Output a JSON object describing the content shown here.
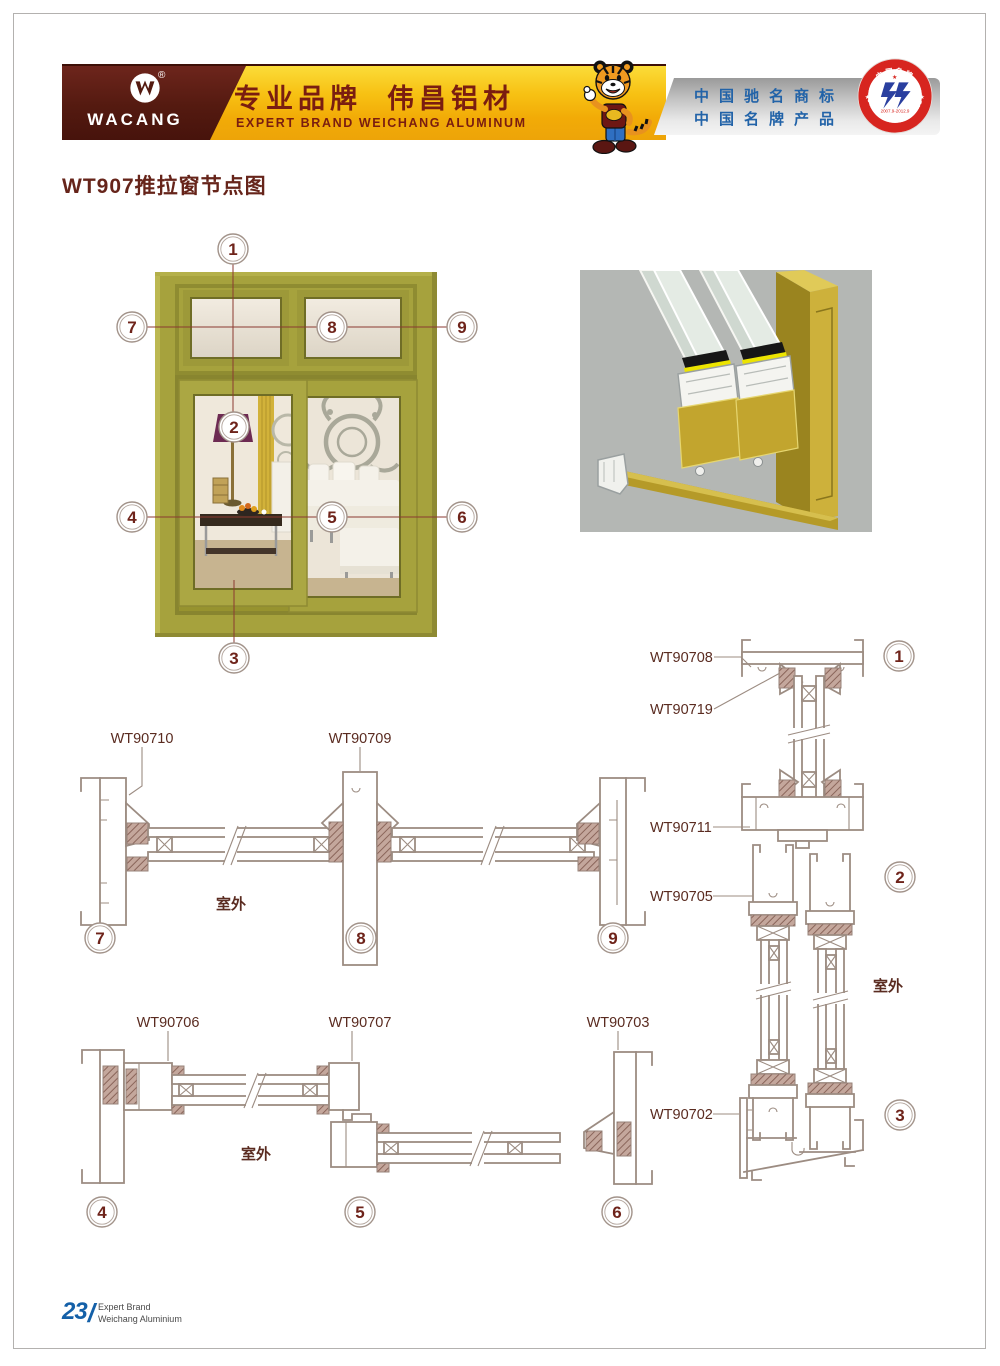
{
  "brand_colors": {
    "maroon": "#541a10",
    "gold": "#f7c113",
    "honor_blue": "#2263a8",
    "olive_frame": "#a6a23d",
    "badge_red": "#d7251f",
    "footer_blue": "#1460a8"
  },
  "header": {
    "logo_text": "WACANG",
    "registered_mark": "®",
    "slogan_cn": "专业品牌  伟昌铝材",
    "slogan_en": "EXPERT BRAND WEICHANG ALUMINUM",
    "honors_line1": "中国驰名商标",
    "honors_line2": "中国名牌产品",
    "badge": {
      "top_text": "中国名牌",
      "bottom_text": "CHINA TOP BRAND",
      "period": "2007.9-2012.9"
    }
  },
  "page": {
    "title": "WT907推拉窗节点图",
    "footer": {
      "page_number": "23",
      "separator": "/",
      "brand_line1": "Expert Brand",
      "brand_line2": "Weichang Aluminium"
    }
  },
  "diagram": {
    "outdoor_label": "室外",
    "callout_numbers": [
      "1",
      "2",
      "3",
      "4",
      "5",
      "6",
      "7",
      "8",
      "9"
    ],
    "profile_labels": {
      "top_section": [
        "WT90710",
        "WT90709"
      ],
      "bottom_section": [
        "WT90706",
        "WT90707",
        "WT90703"
      ],
      "right_section": [
        "WT90708",
        "WT90719",
        "WT90711",
        "WT90705",
        "WT90702"
      ]
    }
  }
}
